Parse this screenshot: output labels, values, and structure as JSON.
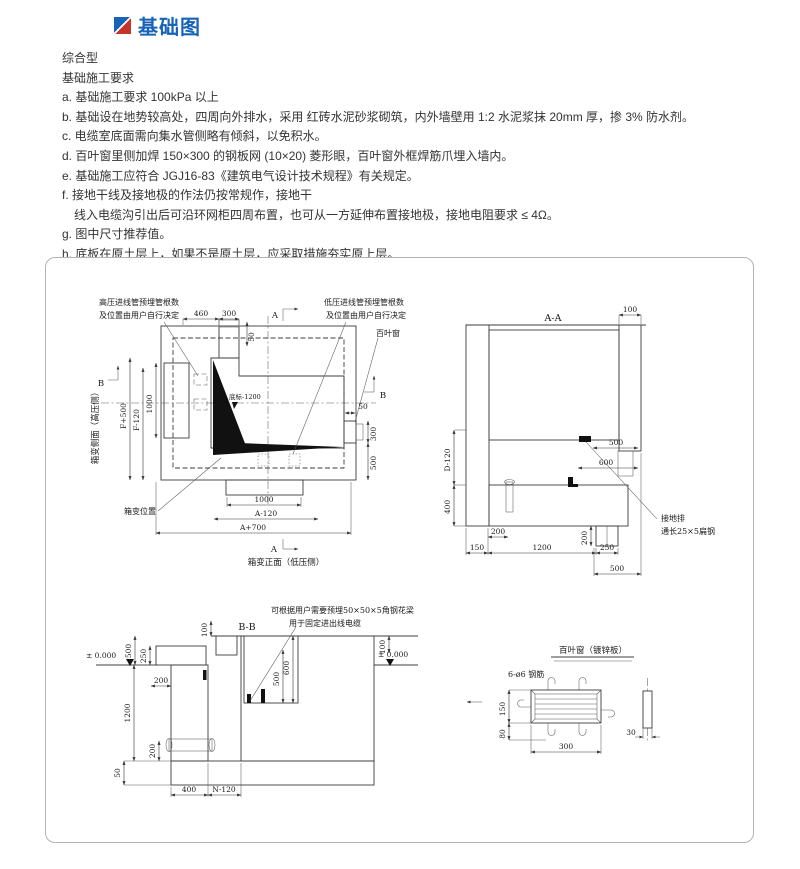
{
  "page": {
    "title": "基础图"
  },
  "colors": {
    "accent_blue": "#1763b8",
    "accent_red": "#c5352b"
  },
  "notes": {
    "type_label": "综合型",
    "heading": "基础施工要求",
    "items": [
      "a. 基础施工要求 100kPa 以上",
      "b. 基础设在地势较高处，四周向外排水，采用 红砖水泥砂浆砌筑，内外墙壁用 1:2 水泥浆抹 20mm 厚，掺 3% 防水剂。",
      "c. 电缆室底面需向集水管侧略有倾斜，以免积水。",
      "d. 百叶窗里侧加焊 150×300 的钢板网 (10×20) 菱形眼，百叶窗外框焊筋爪埋入墙内。",
      "e. 基础施工应符合 JGJ16-83《建筑电气设计技术规程》有关规定。",
      "f. 接地干线及接地极的作法仍按常规作，接地干",
      "　线入电缆沟引出后可沿环网柜四周布置，也可从一方延伸布置接地极，接地电阻要求 ≤ 4Ω。",
      "g. 图中尺寸推荐值。",
      "h. 底板在原土层上，如果不是原土层，应采取措施夯实原上层。"
    ]
  },
  "plan": {
    "caption": "箱变正面（低压侧）",
    "side_label": "箱变侧面（高压侧）",
    "position_label": "箱变位置",
    "louver_label": "百叶窗",
    "level_label": "底标-1200",
    "hv_note1": "高压进线管预埋管根数",
    "hv_note2": "及位置由用户自行决定",
    "lv_note1": "低压进线管预埋管根数",
    "lv_note2": "及位置由用户自行决定",
    "marker_a": "A",
    "marker_b": "B",
    "d460": "460",
    "d300": "300",
    "d50_top": "50",
    "df500": "F+500",
    "df120": "F-120",
    "d1000_left": "1000",
    "d50_right": "50",
    "d300_right": "300",
    "d500_right": "500",
    "d1000_bottom": "1000",
    "da120": "A-120",
    "da700": "A+700"
  },
  "aa": {
    "title": "A-A",
    "earth_label1": "接地排",
    "earth_label2": "通长25×5扁钢",
    "d100": "100",
    "d500": "500",
    "d600": "600",
    "dd120": "D-120",
    "d400": "400",
    "d200a": "200",
    "d200b": "200",
    "d150": "150",
    "d1200": "1200",
    "d250": "250",
    "d500b": "500"
  },
  "bb": {
    "title": "B-B",
    "note1": "可根据用户需要预埋50×50×5角钢花梁",
    "note2": "用于固定进出线电缆",
    "level_left": "± 0.000",
    "level_right": "± 0.000",
    "d100_top": "100",
    "d500": "500",
    "d250": "250",
    "d200_left": "200",
    "d1200": "1200",
    "d200_pipe": "200",
    "d50": "50",
    "d600": "600",
    "d500_opening": "500",
    "d400": "400",
    "dn120": "N-120",
    "d100_right": "100"
  },
  "louver": {
    "title": "百叶窗（镀锌板）",
    "rebar_label": "6-ø6  钢筋",
    "d150": "150",
    "d80": "80",
    "d300": "300",
    "d30": "30"
  }
}
